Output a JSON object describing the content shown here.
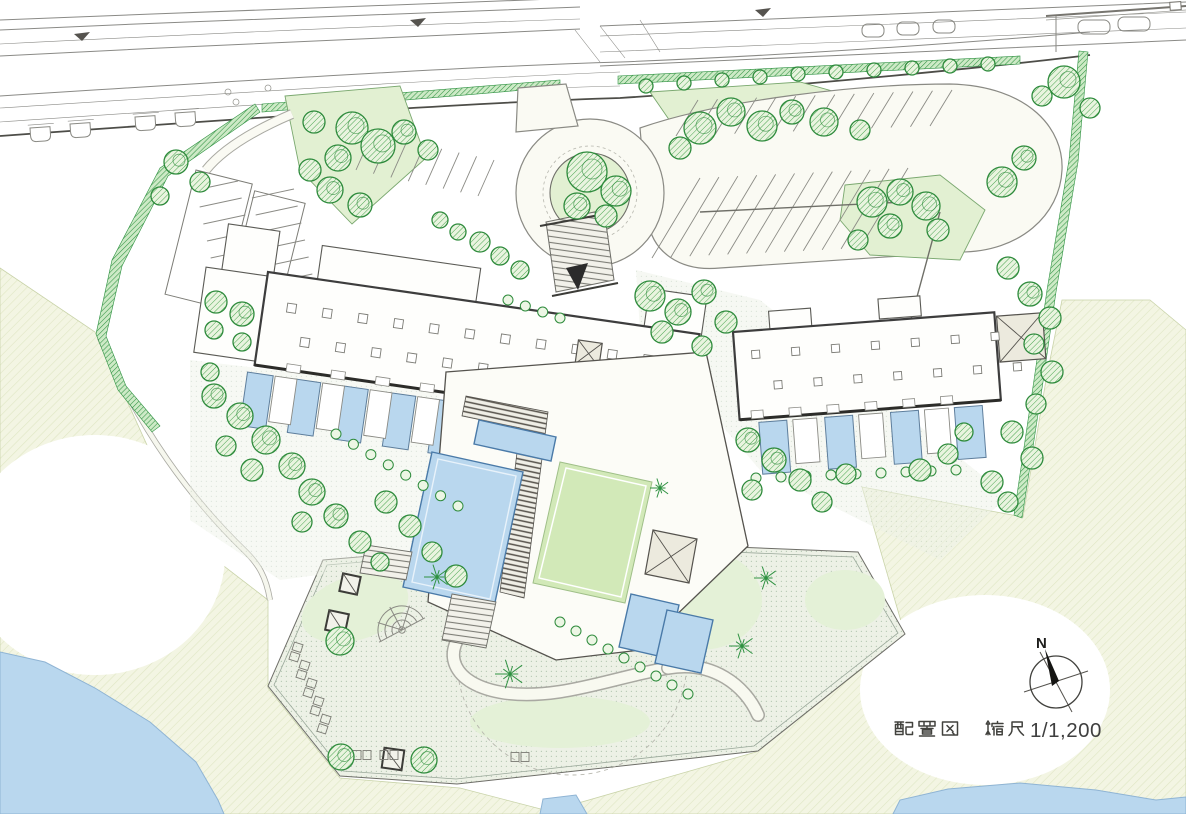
{
  "caption": {
    "title": "配置図",
    "scale_label": "縮尺1/1,200",
    "scale_number": "1/1,200",
    "full": "配置図　縮尺1/1,200"
  },
  "compass": {
    "north_label": "N"
  },
  "colors": {
    "water": "#b9d7ee",
    "pool_edge": "#4a7aa8",
    "lawn": "#d2e9b8",
    "island_green": "#e2f0d2",
    "tree_stroke": "#2e8b3c",
    "hedge_line": "#2f9242",
    "grass_bg": "#f3f5e3",
    "grass_line": "#dfe6c4",
    "plaza_bg": "#edf1e6",
    "plaza_dot": "#b6c9b4",
    "road_line": "#8a8a86",
    "building_line": "#3d3d3d",
    "building_fill": "#fefefc",
    "text": "#3f3f3f",
    "arrow": "#2b2b2b"
  },
  "site": {
    "trees": [
      [
        352,
        128,
        16
      ],
      [
        378,
        146,
        17
      ],
      [
        338,
        158,
        13
      ],
      [
        314,
        122,
        11
      ],
      [
        404,
        132,
        12
      ],
      [
        428,
        150,
        10
      ],
      [
        330,
        190,
        13
      ],
      [
        360,
        205,
        12
      ],
      [
        310,
        170,
        11
      ],
      [
        587,
        172,
        20
      ],
      [
        616,
        191,
        15
      ],
      [
        577,
        206,
        13
      ],
      [
        606,
        216,
        11
      ],
      [
        700,
        128,
        16
      ],
      [
        731,
        112,
        14
      ],
      [
        762,
        126,
        15
      ],
      [
        792,
        112,
        12
      ],
      [
        824,
        122,
        14
      ],
      [
        680,
        148,
        11
      ],
      [
        860,
        130,
        10
      ],
      [
        1002,
        182,
        15
      ],
      [
        1024,
        158,
        12
      ],
      [
        1064,
        82,
        16
      ],
      [
        1042,
        96,
        10
      ],
      [
        1090,
        108,
        10
      ],
      [
        872,
        202,
        15
      ],
      [
        900,
        192,
        13
      ],
      [
        926,
        206,
        14
      ],
      [
        890,
        226,
        12
      ],
      [
        938,
        230,
        11
      ],
      [
        858,
        240,
        10
      ],
      [
        646,
        86,
        7
      ],
      [
        684,
        83,
        7
      ],
      [
        722,
        80,
        7
      ],
      [
        760,
        77,
        7
      ],
      [
        798,
        74,
        7
      ],
      [
        836,
        72,
        7
      ],
      [
        874,
        70,
        7
      ],
      [
        912,
        68,
        7
      ],
      [
        950,
        66,
        7
      ],
      [
        988,
        64,
        7
      ],
      [
        1008,
        268,
        11
      ],
      [
        1030,
        294,
        12
      ],
      [
        1050,
        318,
        11
      ],
      [
        1034,
        344,
        10
      ],
      [
        1052,
        372,
        11
      ],
      [
        1036,
        404,
        10
      ],
      [
        1012,
        432,
        11
      ],
      [
        1032,
        458,
        11
      ],
      [
        992,
        482,
        11
      ],
      [
        1008,
        502,
        10
      ],
      [
        650,
        296,
        15
      ],
      [
        678,
        312,
        13
      ],
      [
        704,
        292,
        12
      ],
      [
        726,
        322,
        11
      ],
      [
        662,
        332,
        11
      ],
      [
        702,
        346,
        10
      ],
      [
        748,
        440,
        12
      ],
      [
        774,
        460,
        12
      ],
      [
        800,
        480,
        11
      ],
      [
        752,
        490,
        10
      ],
      [
        822,
        502,
        10
      ],
      [
        846,
        474,
        10
      ],
      [
        214,
        396,
        12
      ],
      [
        240,
        416,
        13
      ],
      [
        266,
        440,
        14
      ],
      [
        292,
        466,
        13
      ],
      [
        252,
        470,
        11
      ],
      [
        226,
        446,
        10
      ],
      [
        312,
        492,
        13
      ],
      [
        336,
        516,
        12
      ],
      [
        360,
        542,
        11
      ],
      [
        302,
        522,
        10
      ],
      [
        386,
        502,
        11
      ],
      [
        410,
        526,
        11
      ],
      [
        432,
        552,
        10
      ],
      [
        456,
        576,
        11
      ],
      [
        380,
        562,
        9
      ],
      [
        210,
        372,
        9
      ],
      [
        176,
        162,
        12
      ],
      [
        200,
        182,
        10
      ],
      [
        160,
        196,
        9
      ],
      [
        216,
        302,
        11
      ],
      [
        242,
        314,
        12
      ],
      [
        214,
        330,
        9
      ],
      [
        242,
        342,
        9
      ],
      [
        480,
        242,
        10
      ],
      [
        500,
        256,
        9
      ],
      [
        520,
        270,
        9
      ],
      [
        440,
        220,
        8
      ],
      [
        458,
        232,
        8
      ],
      [
        920,
        470,
        11
      ],
      [
        948,
        454,
        10
      ],
      [
        964,
        432,
        9
      ],
      [
        340,
        641,
        14
      ],
      [
        341,
        757,
        13
      ],
      [
        424,
        760,
        13
      ]
    ],
    "shrub_chains": [
      [
        336,
        434,
        458,
        506,
        8
      ],
      [
        560,
        622,
        688,
        694,
        9
      ],
      [
        756,
        478,
        956,
        470,
        9
      ],
      [
        508,
        300,
        560,
        318,
        4
      ]
    ],
    "stall_fans": [
      {
        "x0": 698,
        "y0": 100,
        "x1": 952,
        "y1": 90,
        "n": 14,
        "dx": -22,
        "dy": 36
      },
      {
        "x0": 700,
        "y0": 178,
        "x1": 908,
        "y1": 168,
        "n": 12,
        "dx": -48,
        "dy": 80
      },
      {
        "x0": 356,
        "y0": 170,
        "x1": 478,
        "y1": 196,
        "n": 8,
        "dx": 16,
        "dy": -36
      },
      {
        "x0": 196,
        "y0": 190,
        "x1": 218,
        "y1": 292,
        "n": 7,
        "dx": 42,
        "dy": -9
      },
      {
        "x0": 252,
        "y0": 198,
        "x1": 274,
        "y1": 300,
        "n": 7,
        "dx": 42,
        "dy": -9
      }
    ],
    "stall_spines": [
      [
        700,
        212,
        905,
        202
      ],
      [
        940,
        212,
        908,
        330
      ]
    ],
    "starbursts": [
      [
        437,
        577,
        13
      ],
      [
        510,
        674,
        15
      ],
      [
        766,
        578,
        12
      ],
      [
        742,
        646,
        13
      ],
      [
        660,
        488,
        10
      ]
    ],
    "bench_pairs": [
      [
        296,
        652,
        -72
      ],
      [
        303,
        670,
        -72
      ],
      [
        310,
        688,
        -72
      ],
      [
        317,
        706,
        -72
      ],
      [
        324,
        724,
        -72
      ],
      [
        362,
        755,
        0
      ],
      [
        389,
        755,
        0
      ],
      [
        520,
        757,
        0
      ]
    ],
    "planters": [
      [
        350,
        584,
        18,
        12
      ],
      [
        337,
        622,
        20,
        12
      ],
      [
        393,
        759,
        20,
        8
      ]
    ],
    "road_bays": [
      [
        30,
        128,
        -4
      ],
      [
        70,
        124,
        -4
      ],
      [
        135,
        117,
        -4
      ],
      [
        175,
        113,
        -4
      ],
      [
        287,
        103,
        -4
      ],
      [
        326,
        100,
        -4
      ]
    ],
    "road_islands": [
      [
        862,
        24,
        22,
        13
      ],
      [
        897,
        22,
        22,
        13
      ],
      [
        933,
        20,
        22,
        13
      ],
      [
        1078,
        20,
        32,
        14
      ],
      [
        1118,
        17,
        32,
        14
      ]
    ],
    "road_triangles": [
      [
        82,
        34
      ],
      [
        418,
        20
      ],
      [
        763,
        10
      ]
    ],
    "road_dots": [
      [
        228,
        92
      ],
      [
        236,
        102
      ],
      [
        268,
        88
      ]
    ]
  }
}
